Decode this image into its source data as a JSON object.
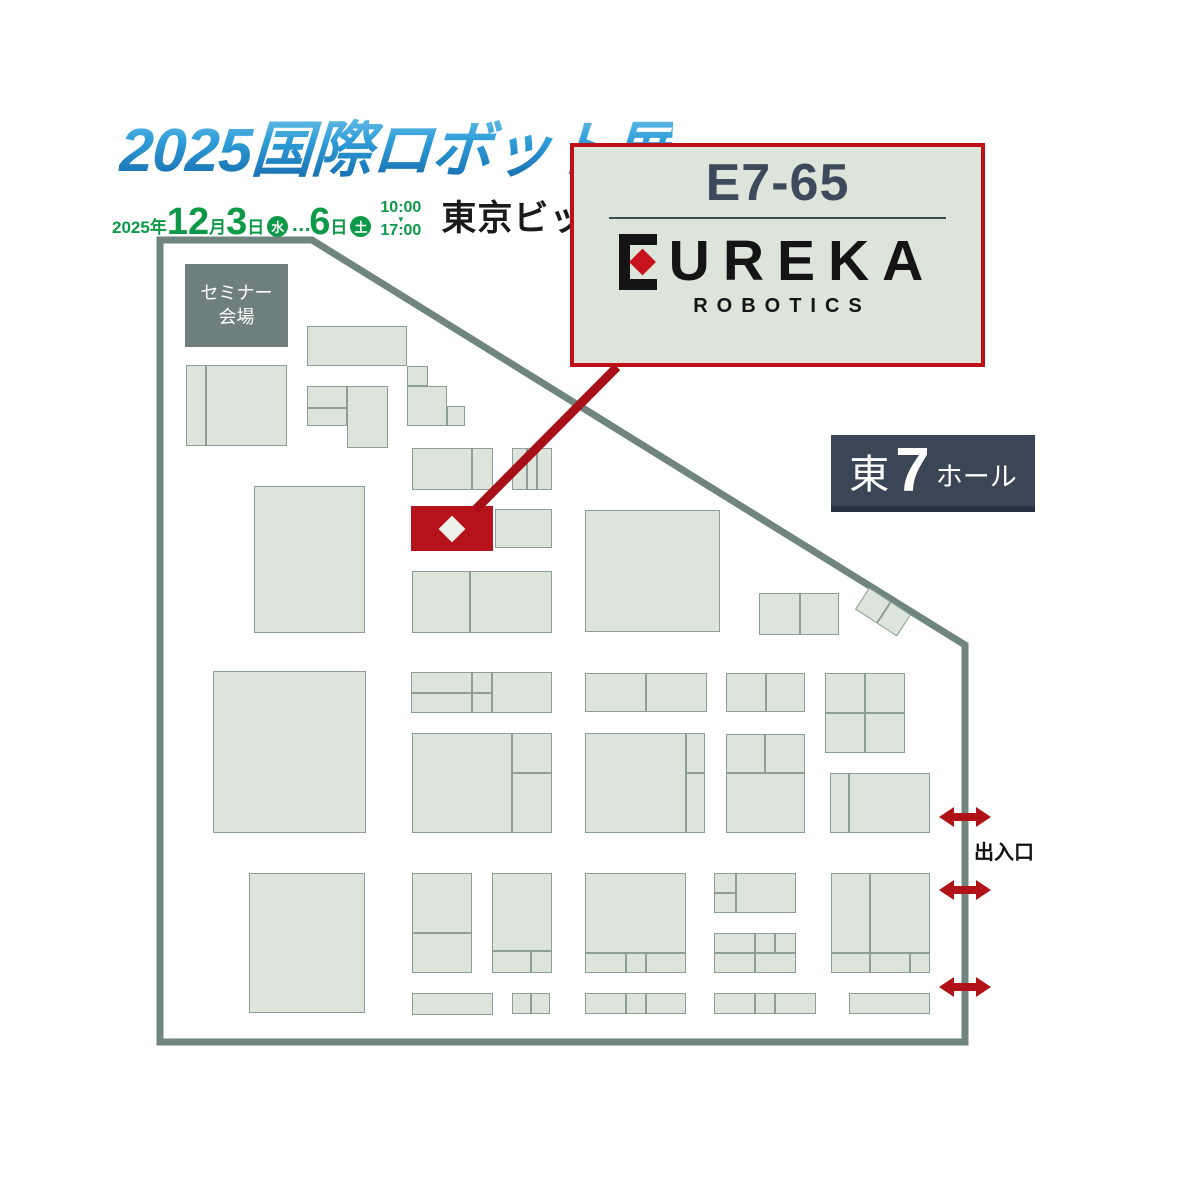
{
  "header": {
    "title": "2025国際ロボット展",
    "date_line": {
      "year": "2025",
      "year_suffix": "年",
      "month": "12",
      "month_suffix": "月",
      "day_start": "3",
      "day_start_suffix": "日",
      "day_start_week": "水",
      "ellipsis": "…",
      "day_end": "6",
      "day_end_suffix": "日",
      "day_end_week": "土",
      "time_open": "10:00",
      "time_arrow": "▼",
      "time_close": "17:00",
      "venue": "東京ビッグサイト"
    }
  },
  "callout": {
    "booth_no": "E7-65",
    "brand_rest": "UREKA",
    "brand_sub": "ROBOTICS"
  },
  "hall_badge": {
    "prefix": "東",
    "number": "7",
    "suffix": "ホール"
  },
  "map": {
    "seminar_label_line1": "セミナー",
    "seminar_label_line2": "会場",
    "exit_label": "出入口",
    "colors": {
      "outline": "#71857f",
      "booth_fill": "#dde4db",
      "booth_border": "#8d9d97",
      "highlight_red": "#b5121b",
      "callout_red": "#bf1017",
      "navy_badge": "#3a4656",
      "date_green": "#0d9a48",
      "logo_blue": "#2f9ed8"
    },
    "outline_points": "160,240 312,240 965,645 965,1042 160,1042",
    "connector": {
      "x1": 617,
      "y1": 367,
      "x2": 476,
      "y2": 509
    },
    "highlight_booth": {
      "x": 411,
      "y": 506,
      "w": 82,
      "h": 45
    },
    "exits": [
      {
        "x": 939,
        "y": 807
      },
      {
        "x": 939,
        "y": 880
      },
      {
        "x": 939,
        "y": 977
      }
    ],
    "booths": [
      [
        186,
        365,
        20,
        81
      ],
      [
        206,
        365,
        81,
        81
      ],
      [
        307,
        326,
        100,
        40
      ],
      [
        407,
        366,
        21,
        20
      ],
      [
        407,
        386,
        40,
        40
      ],
      [
        447,
        406,
        18,
        20
      ],
      [
        307,
        386,
        40,
        22
      ],
      [
        307,
        408,
        40,
        18
      ],
      [
        347,
        386,
        41,
        62
      ],
      [
        412,
        448,
        60,
        42
      ],
      [
        472,
        448,
        21,
        42
      ],
      [
        512,
        448,
        15,
        42
      ],
      [
        527,
        448,
        10,
        42
      ],
      [
        537,
        448,
        15,
        42
      ],
      [
        495,
        509,
        57,
        39
      ],
      [
        412,
        571,
        58,
        62
      ],
      [
        470,
        571,
        82,
        62
      ],
      [
        254,
        486,
        111,
        147
      ],
      [
        585,
        510,
        135,
        122
      ],
      [
        759,
        593,
        41,
        42
      ],
      [
        800,
        593,
        39,
        42
      ],
      [
        213,
        671,
        153,
        162
      ],
      [
        411,
        672,
        61,
        21
      ],
      [
        411,
        693,
        61,
        20
      ],
      [
        472,
        672,
        20,
        21
      ],
      [
        472,
        693,
        20,
        20
      ],
      [
        492,
        672,
        60,
        41
      ],
      [
        412,
        733,
        100,
        100
      ],
      [
        512,
        733,
        40,
        40
      ],
      [
        512,
        773,
        40,
        60
      ],
      [
        585,
        673,
        61,
        39
      ],
      [
        646,
        673,
        61,
        39
      ],
      [
        726,
        673,
        40,
        39
      ],
      [
        766,
        673,
        39,
        39
      ],
      [
        825,
        673,
        40,
        40
      ],
      [
        865,
        673,
        40,
        40
      ],
      [
        825,
        713,
        40,
        40
      ],
      [
        865,
        713,
        40,
        40
      ],
      [
        585,
        733,
        101,
        100
      ],
      [
        686,
        733,
        19,
        40
      ],
      [
        686,
        773,
        19,
        60
      ],
      [
        726,
        734,
        39,
        39
      ],
      [
        765,
        734,
        40,
        39
      ],
      [
        726,
        773,
        79,
        60
      ],
      [
        830,
        773,
        19,
        60
      ],
      [
        849,
        773,
        81,
        60
      ],
      [
        249,
        873,
        116,
        140
      ],
      [
        412,
        873,
        60,
        60
      ],
      [
        412,
        933,
        60,
        40
      ],
      [
        492,
        873,
        60,
        78
      ],
      [
        492,
        951,
        39,
        22
      ],
      [
        531,
        951,
        21,
        22
      ],
      [
        585,
        873,
        101,
        80
      ],
      [
        585,
        953,
        41,
        20
      ],
      [
        626,
        953,
        20,
        20
      ],
      [
        646,
        953,
        40,
        20
      ],
      [
        714,
        873,
        22,
        20
      ],
      [
        714,
        893,
        22,
        20
      ],
      [
        736,
        873,
        60,
        40
      ],
      [
        714,
        933,
        41,
        20
      ],
      [
        755,
        933,
        20,
        20
      ],
      [
        775,
        933,
        21,
        20
      ],
      [
        714,
        953,
        41,
        20
      ],
      [
        755,
        953,
        41,
        20
      ],
      [
        831,
        873,
        39,
        80
      ],
      [
        870,
        873,
        60,
        80
      ],
      [
        831,
        953,
        39,
        20
      ],
      [
        870,
        953,
        40,
        20
      ],
      [
        910,
        953,
        20,
        20
      ],
      [
        412,
        993,
        81,
        22
      ],
      [
        512,
        993,
        19,
        21
      ],
      [
        531,
        993,
        19,
        21
      ],
      [
        585,
        993,
        41,
        21
      ],
      [
        626,
        993,
        20,
        21
      ],
      [
        646,
        993,
        40,
        21
      ],
      [
        714,
        993,
        41,
        21
      ],
      [
        755,
        993,
        20,
        21
      ],
      [
        775,
        993,
        41,
        21
      ],
      [
        849,
        993,
        81,
        21
      ]
    ]
  }
}
